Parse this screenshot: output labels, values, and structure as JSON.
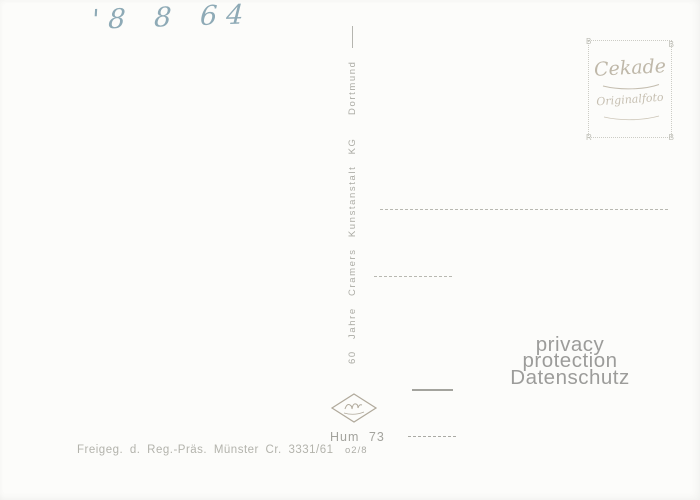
{
  "postcard": {
    "handwritten_date": "'8 8 64",
    "stamp_box": {
      "brand": "Cekade",
      "subtitle": "Originalfoto",
      "corner_tl": "B",
      "corner_tr": "B",
      "corner_bl": "R",
      "corner_br": "B"
    },
    "publisher_divider_text": "60 Jahre Cramers Kunstanstalt KG  Dortmund",
    "watermark": {
      "line1": "privacy protection",
      "line2": "Datenschutz"
    },
    "logo": "agfa-diamond",
    "print_code_line1": "Hum 73",
    "print_code_line2": "o2/8",
    "approval_line": "Freigeg. d. Reg.-Präs. Münster Cr. 3331/61"
  },
  "colors": {
    "paper": "#fcfcfa",
    "print_gray": "#a9a9a3",
    "handwriting_blue": "#7b9cab",
    "stamp_beige": "#bfb8a9",
    "watermark_gray": "#9c9c9a"
  }
}
